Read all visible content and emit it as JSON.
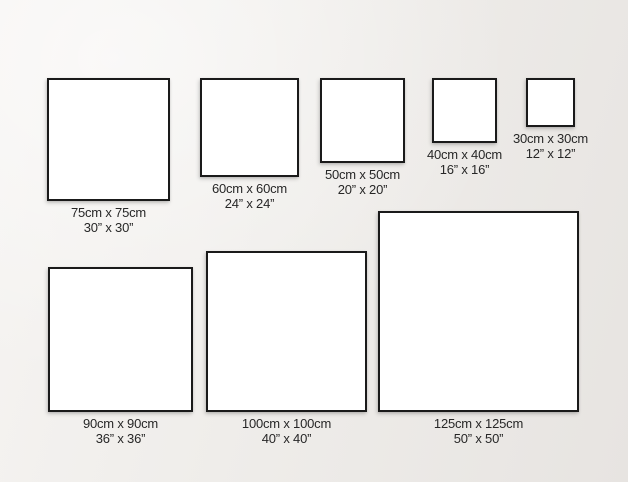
{
  "page": {
    "title": "Square canvas size comparison guide",
    "units": [
      "cm",
      "inches"
    ]
  },
  "colors": {
    "background": "#efede9",
    "square_fill": "#ffffff",
    "square_border": "#1a1a1a",
    "label_text": "#272727"
  },
  "sizes": [
    {
      "id": "75x75",
      "cm": "75cm x 75cm",
      "inches": "30” x 30”"
    },
    {
      "id": "60x60",
      "cm": "60cm x 60cm",
      "inches": "24” x 24”"
    },
    {
      "id": "50x50",
      "cm": "50cm x 50cm",
      "inches": "20” x 20”"
    },
    {
      "id": "40x40",
      "cm": "40cm x 40cm",
      "inches": "16” x 16”"
    },
    {
      "id": "30x30",
      "cm": "30cm x 30cm",
      "inches": "12” x 12”"
    },
    {
      "id": "90x90",
      "cm": "90cm x 90cm",
      "inches": "36” x 36”"
    },
    {
      "id": "100x100",
      "cm": "100cm x 100cm",
      "inches": "40” x 40”"
    },
    {
      "id": "125x125",
      "cm": "125cm x 125cm",
      "inches": "50” x 50”"
    }
  ]
}
